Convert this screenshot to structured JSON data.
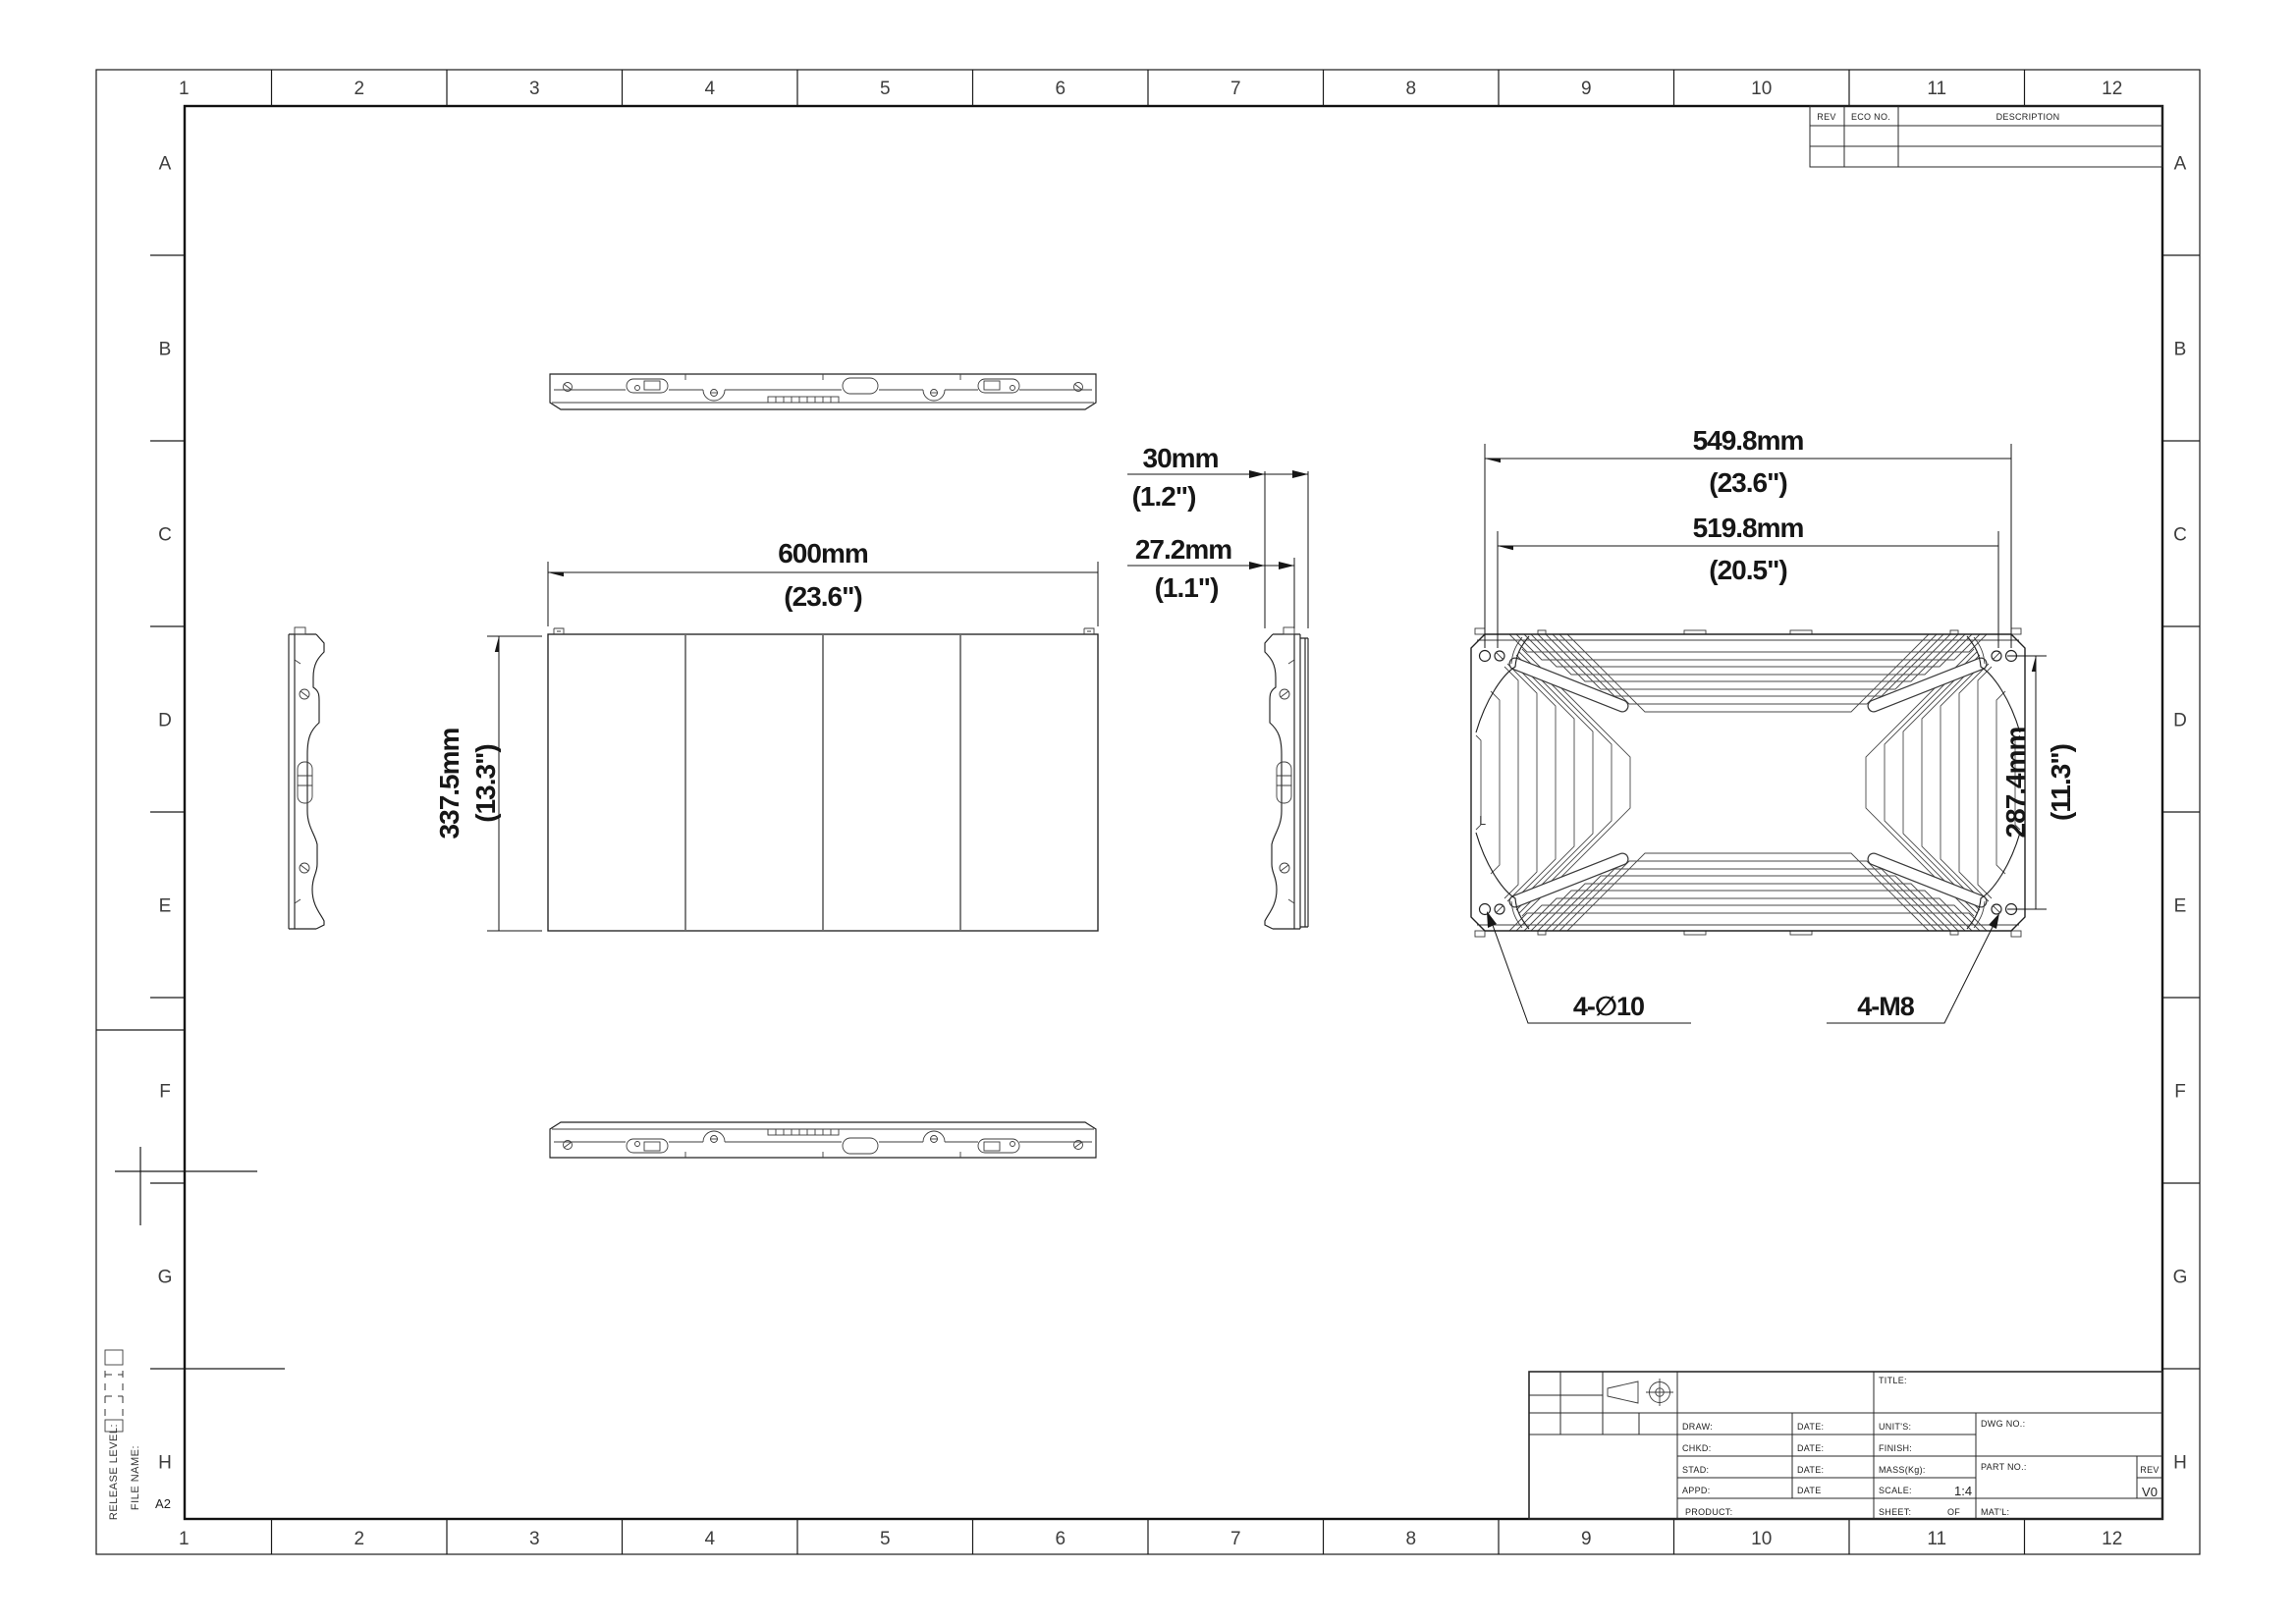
{
  "sheet": {
    "columns": [
      "1",
      "2",
      "3",
      "4",
      "5",
      "6",
      "7",
      "8",
      "9",
      "10",
      "11",
      "12"
    ],
    "rows": [
      "A",
      "B",
      "C",
      "D",
      "E",
      "F",
      "G",
      "H"
    ],
    "size_label": "A2",
    "release_level_label": "RELEASE LEVEL:",
    "file_name_label": "FILE NAME:"
  },
  "revision_table": {
    "rev": "REV",
    "eco_no": "ECO NO.",
    "description": "DESCRIPTION"
  },
  "title_block": {
    "title": "TITLE:",
    "draw": "DRAW:",
    "chkd": "CHKD:",
    "stad": "STAD:",
    "appd": "APPD:",
    "product": "PRODUCT:",
    "date1": "DATE:",
    "date2": "DATE:",
    "date3": "DATE:",
    "date4": "DATE",
    "units": "UNIT'S:",
    "finish": "FINISH:",
    "mass": "MASS(Kg):",
    "scale": "SCALE:",
    "scale_value": "1:4",
    "sheet": "SHEET:",
    "of": "OF",
    "dwg_no": "DWG NO.:",
    "part_no": "PART NO.:",
    "rev": "REV",
    "rev_value": "V0",
    "matl": "MAT'L:"
  },
  "dimensions": {
    "front_width_mm": "600mm",
    "front_width_in": "(23.6\")",
    "front_height_mm": "337.5mm",
    "front_height_in": "(13.3\")",
    "depth_total_mm": "30mm",
    "depth_total_in": "(1.2\")",
    "depth_panel_mm": "27.2mm",
    "depth_panel_in": "(1.1\")",
    "rear_width_outer_mm": "549.8mm",
    "rear_width_outer_in": "(23.6\")",
    "rear_width_inner_mm": "519.8mm",
    "rear_width_inner_in": "(20.5\")",
    "rear_height_mm": "287.4mm",
    "rear_height_in": "(11.3\")",
    "clearance_holes": "4-∅10",
    "threaded_holes": "4-M8",
    "orientation_label": "L"
  }
}
